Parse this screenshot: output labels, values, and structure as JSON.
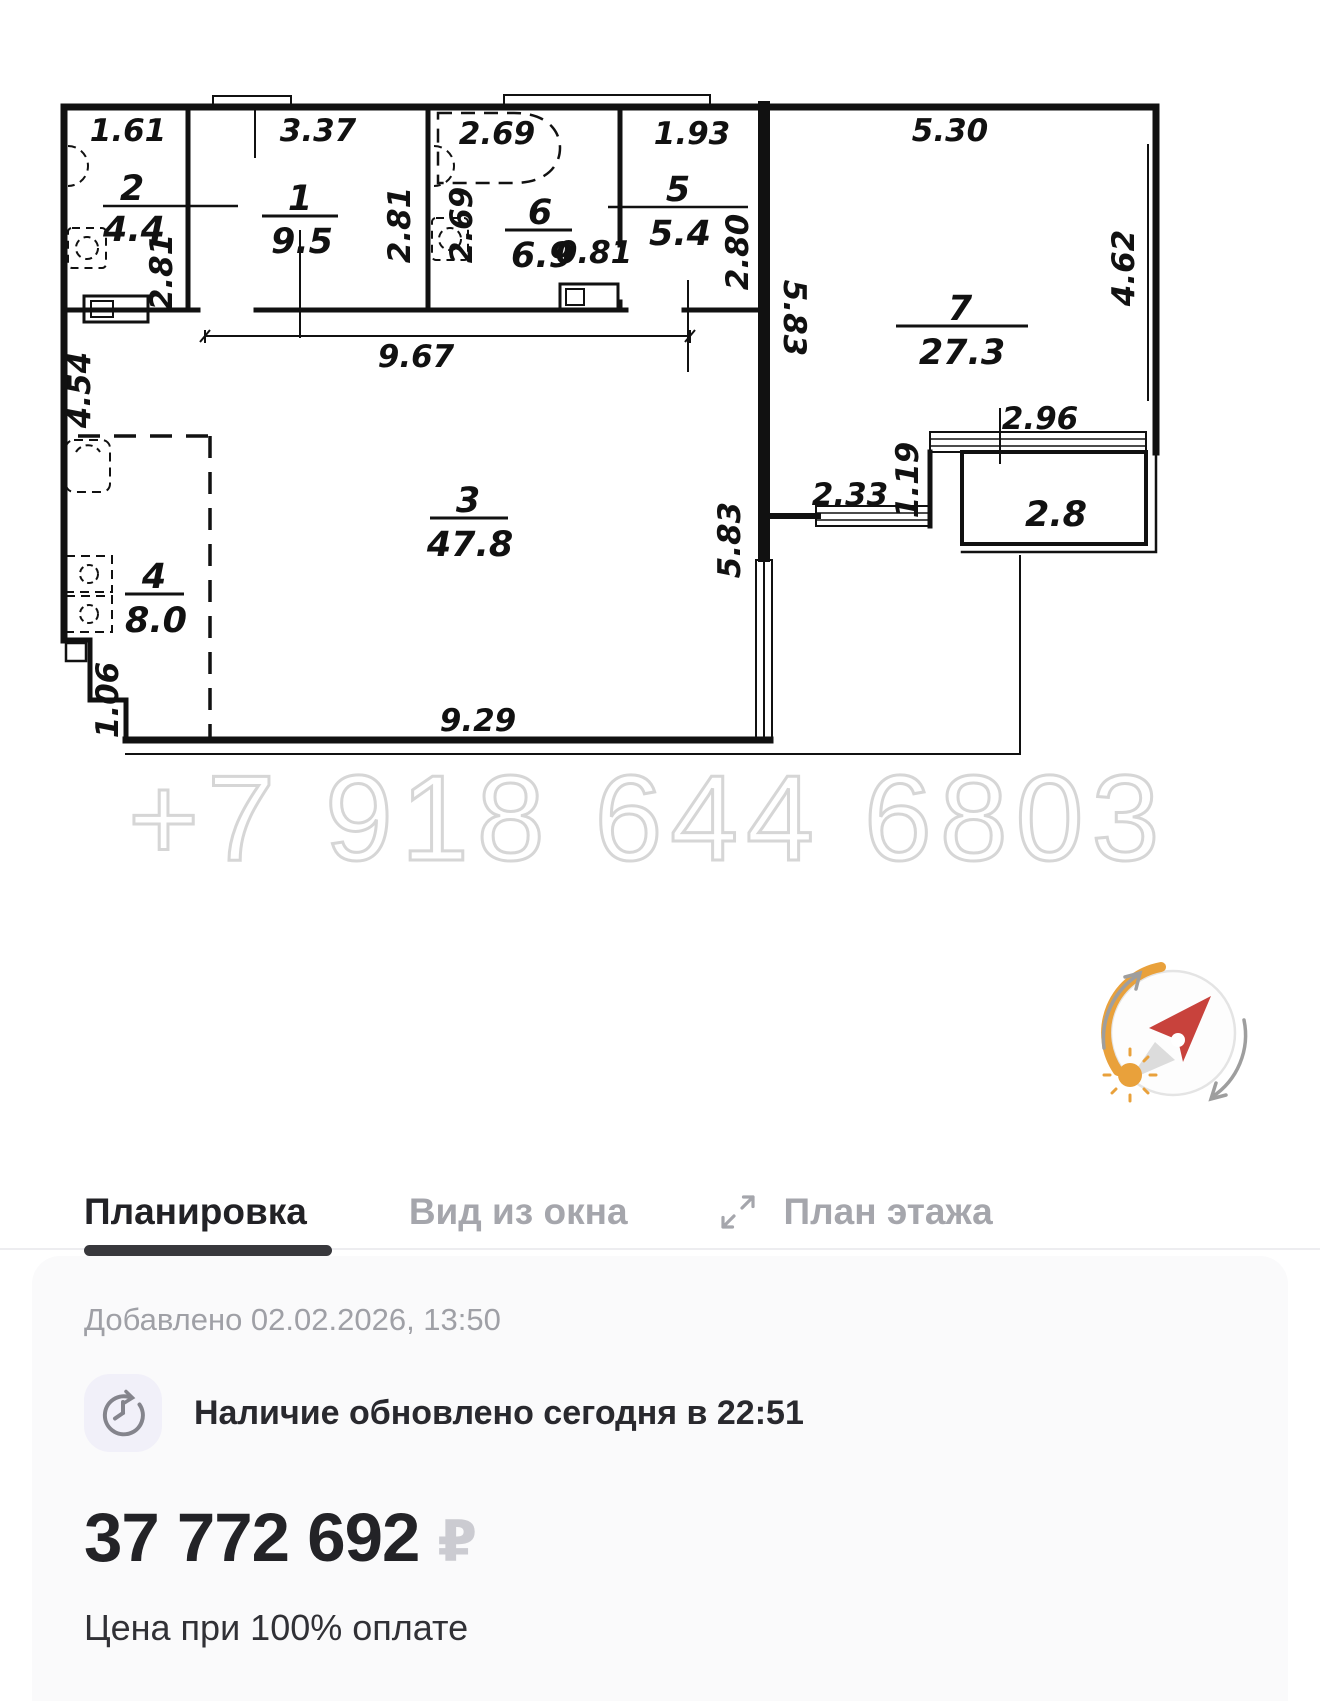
{
  "fp": {
    "rooms": {
      "r1": {
        "n": "1",
        "a": "9.5"
      },
      "r2": {
        "n": "2",
        "a": "4.4"
      },
      "r3": {
        "n": "3",
        "a": "47.8"
      },
      "r4": {
        "n": "4",
        "a": "8.0"
      },
      "r5": {
        "n": "5",
        "a": "5.4"
      },
      "r6": {
        "n": "6",
        "a": "6.9"
      },
      "r7": {
        "n": "7",
        "a": "27.3"
      },
      "balcony": "2.8"
    },
    "dims": {
      "top_w2": "1.61",
      "top_w1": "3.37",
      "top_w6": "2.69",
      "top_w5": "1.93",
      "top_w7": "5.30",
      "h_r2": "2.81",
      "h_r1": "2.81",
      "h_r6": "2.69",
      "h_r5": "2.80",
      "door_r6": "0.81",
      "corridor": "9.67",
      "left_r3": "4.54",
      "r3_right": "5.83",
      "r7_left": "5.83",
      "r7_right": "4.62",
      "balc_top": "2.96",
      "balc_step": "1.19",
      "balc_win": "2.33",
      "notch": "1.06",
      "bottom": "9.29"
    }
  },
  "watermark": "+7 918 644 6803",
  "tabs": {
    "planirovka": "Планировка",
    "vid_iz_okna": "Вид из окна",
    "plan_etazha": "План этажа"
  },
  "icons": {
    "expand": "expand-diagonal-arrows",
    "clock_refresh": "clock-update",
    "compass": "compass-sun-orientation"
  },
  "colors": {
    "accent_orange": "#e9a13b",
    "needle_red": "#c8423c",
    "active_tab": "#222226",
    "inactive_tab": "#a5a6ac",
    "card_bg": "#fafafb"
  },
  "card": {
    "added": "Добавлено 02.02.2026, 13:50",
    "availability": "Наличие обновлено сегодня в 22:51",
    "price": "37 772 692",
    "currency": "₽",
    "note": "Цена при 100% оплате"
  }
}
